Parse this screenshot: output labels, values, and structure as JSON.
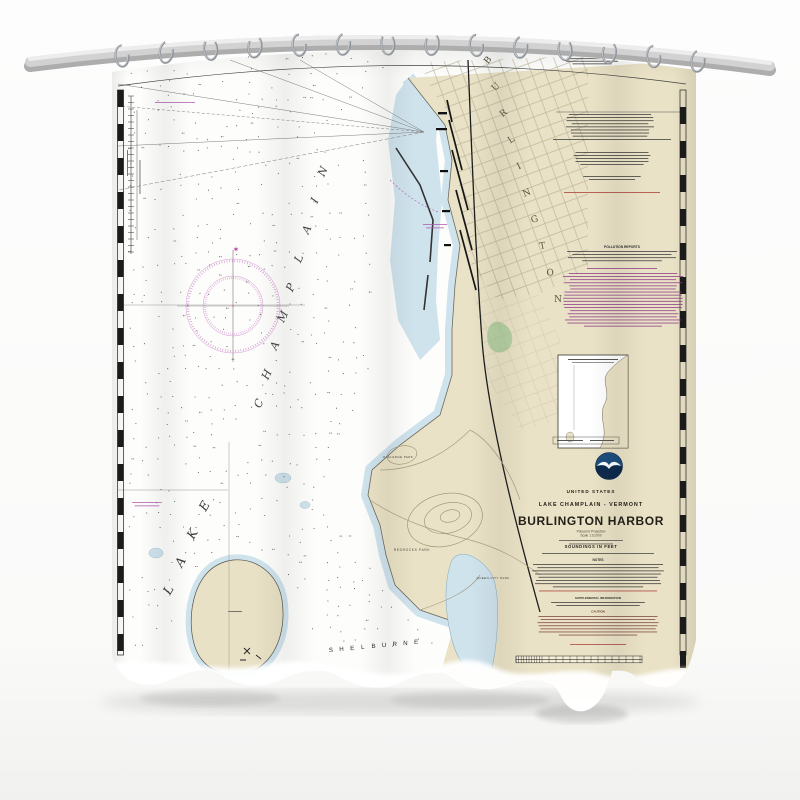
{
  "chart": {
    "colors": {
      "paper": "#fdfdfb",
      "land_tan": "#eae2c6",
      "shallow_blue": "#cfe3ed",
      "park_green": "#b5cfa2",
      "compass_magenta": "#c06cc0",
      "note_magenta": "#8e3a88",
      "note_red": "#a93b36",
      "border_black": "#1c1c1c",
      "title_ink": "#23201a"
    },
    "labels": {
      "lake_line1": "LAKE",
      "lake_line2": "CHAMPLAIN",
      "city": "BURLINGTON",
      "town": "SHELBURNE",
      "park_oakledge": "OAKLEDGE PARK",
      "park_redrocks": "REDROCKS PARK",
      "park_queen_city": "QUEEN CITY PARK"
    },
    "title_block": {
      "nation": "UNITED STATES",
      "region": "LAKE CHAMPLAIN - VERMONT",
      "title": "BURLINGTON HARBOR",
      "projection": "Polyconic Projection",
      "scale": "Scale 1:10,000",
      "soundings": "SOUNDINGS IN FEET"
    },
    "note_headings": {
      "notes": "NOTES",
      "pollution": "POLLUTION REPORTS",
      "supplemental": "SUPPLEMENTAL INFORMATION",
      "caution": "CAUTION"
    }
  }
}
